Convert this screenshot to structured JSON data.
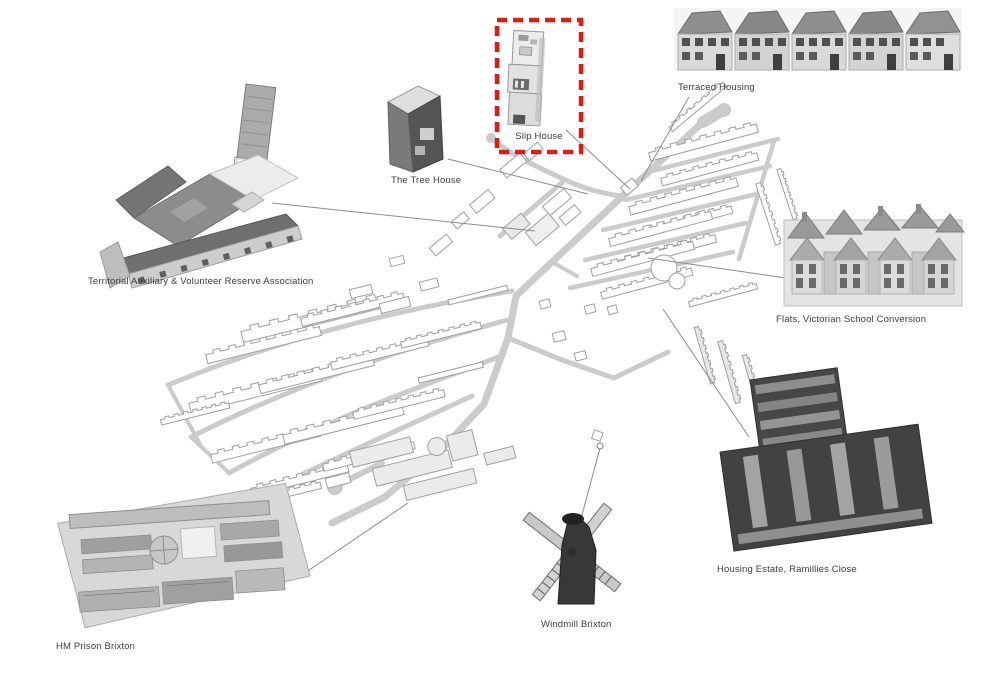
{
  "callouts": [
    {
      "id": "slip-house",
      "label": "Slip House",
      "highlighted": true
    },
    {
      "id": "tree-house",
      "label": "The Tree House",
      "highlighted": false
    },
    {
      "id": "terraced-housing",
      "label": "Terraced Housing",
      "highlighted": false
    },
    {
      "id": "tavra",
      "label": "Territorial Auxiliary & Volunteer Reserve Association",
      "highlighted": false
    },
    {
      "id": "flats-school",
      "label": "Flats, Victorian School Conversion",
      "highlighted": false
    },
    {
      "id": "ramillies",
      "label": "Housing Estate, Ramillies Close",
      "highlighted": false
    },
    {
      "id": "windmill",
      "label": "Windmill Brixton",
      "highlighted": false
    },
    {
      "id": "prison",
      "label": "HM Prison Brixton",
      "highlighted": false
    }
  ],
  "colors": {
    "highlight": "#e01b10",
    "roads": "#cbcbcb",
    "outlines": "#9f9f9f",
    "leader": "#8c8c8c",
    "label_text": "#3c3c3c"
  }
}
